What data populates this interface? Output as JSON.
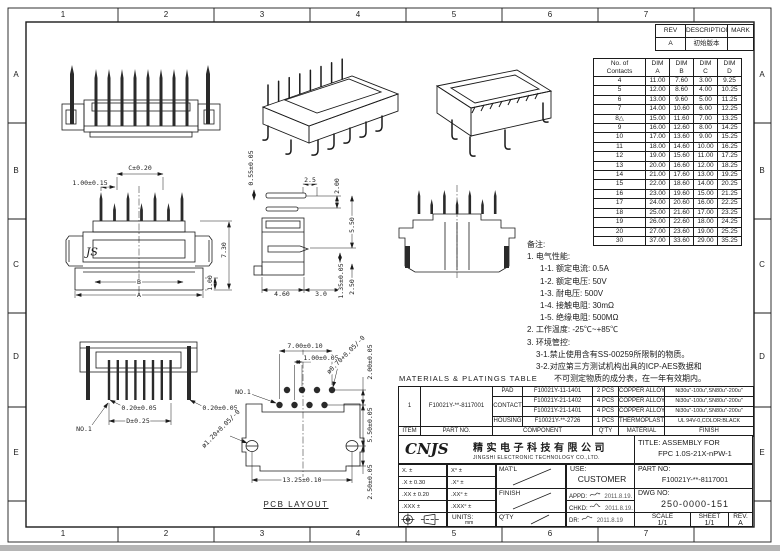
{
  "sheet": {
    "line_color": "#1b1b1b",
    "background": "#ffffff"
  },
  "grid": {
    "cols": [
      "1",
      "2",
      "3",
      "4",
      "5",
      "6",
      "7"
    ],
    "rows": [
      "A",
      "B",
      "C",
      "D",
      "E"
    ]
  },
  "rev_table": {
    "headers": [
      "REV",
      "DESCRIPTION",
      "MARK"
    ],
    "rows": [
      [
        "A",
        "初始版本",
        ""
      ]
    ]
  },
  "dim_table": {
    "col_headers": [
      [
        "No. of",
        "Contacts"
      ],
      [
        "DIM",
        "A"
      ],
      [
        "DIM",
        "B"
      ],
      [
        "DIM",
        "C"
      ],
      [
        "DIM",
        "D"
      ]
    ],
    "rows": [
      [
        "4",
        "11.00",
        "7.60",
        "3.00",
        "9.25"
      ],
      [
        "5",
        "12.00",
        "8.60",
        "4.00",
        "10.25"
      ],
      [
        "6",
        "13.00",
        "9.60",
        "5.00",
        "11.25"
      ],
      [
        "7",
        "14.00",
        "10.60",
        "6.00",
        "12.25"
      ],
      [
        "8△",
        "15.00",
        "11.60",
        "7.00",
        "13.25"
      ],
      [
        "9",
        "16.00",
        "12.60",
        "8.00",
        "14.25"
      ],
      [
        "10",
        "17.00",
        "13.60",
        "9.00",
        "15.25"
      ],
      [
        "11",
        "18.00",
        "14.60",
        "10.00",
        "16.25"
      ],
      [
        "12",
        "19.00",
        "15.60",
        "11.00",
        "17.25"
      ],
      [
        "13",
        "20.00",
        "16.60",
        "12.00",
        "18.25"
      ],
      [
        "14",
        "21.00",
        "17.60",
        "13.00",
        "19.25"
      ],
      [
        "15",
        "22.00",
        "18.60",
        "14.00",
        "20.25"
      ],
      [
        "16",
        "23.00",
        "19.60",
        "15.00",
        "21.25"
      ],
      [
        "17",
        "24.00",
        "20.60",
        "16.00",
        "22.25"
      ],
      [
        "18",
        "25.00",
        "21.60",
        "17.00",
        "23.25"
      ],
      [
        "19",
        "26.00",
        "22.60",
        "18.00",
        "24.25"
      ],
      [
        "20",
        "27.00",
        "23.60",
        "19.00",
        "25.25"
      ],
      [
        "30",
        "37.00",
        "33.60",
        "29.00",
        "35.25"
      ]
    ]
  },
  "notes": {
    "lines": [
      {
        "t": "备注:",
        "i": 0
      },
      {
        "t": "1. 电气性能:",
        "i": 0
      },
      {
        "t": "1-1. 额定电流: 0.5A",
        "i": 13
      },
      {
        "t": "1-2. 额定电压: 50V",
        "i": 13
      },
      {
        "t": "1-3. 耐电压: 500V",
        "i": 13
      },
      {
        "t": "1-4. 接触电阻: 30mΩ",
        "i": 13
      },
      {
        "t": "1-5. 绝缘电阻: 500MΩ",
        "i": 13
      },
      {
        "t": "2. 工作温度: -25℃~+85℃",
        "i": 0
      },
      {
        "t": "3. 环境管控:",
        "i": 0
      },
      {
        "t": "3-1.禁止使用含有SS-00259所限制的物质。",
        "i": 9
      },
      {
        "t": "3-2.对应第三方测试机构出具的ICP-AES数据和",
        "i": 9
      },
      {
        "t": "不可测定物质的成分表，在一年有效期内。",
        "i": 27
      }
    ]
  },
  "materials": {
    "title": "MATERIALS & PLATINGS TABLE",
    "footer_headers": [
      "ITEM",
      "PART NO.",
      "COMPONENT",
      "Q'TY",
      "MATERIAL",
      "FINISH"
    ],
    "item": "1",
    "part_no": "F10021Y-**-8117001",
    "rows": [
      {
        "component": "PAD",
        "part": "F10021Y-11-1401",
        "qty": "2 PCS",
        "material": "COPPER ALLOY",
        "finish": "Ni30u\"-100u\",SN80u\"-200u\""
      },
      {
        "component": "CONTACT",
        "part": "F10021Y-21-1402",
        "qty": "4 PCS",
        "material": "COPPER ALLOY",
        "finish": "Ni30u\"-100u\",SN80u\"-200u\""
      },
      {
        "component": "",
        "part": "F10021Y-21-1401",
        "qty": "4 PCS",
        "material": "COPPER ALLOY",
        "finish": "Ni30u\"-100u\",SN80u\"-200u\""
      },
      {
        "component": "HOUSING",
        "part": "F10021Y-**-2726",
        "qty": "1 PCS",
        "material": "THERMOPLASTIC",
        "finish": "UL 94V-0,COLOR:BLACK"
      }
    ]
  },
  "title_block": {
    "logo": "CNJS",
    "company_cn": "精实电子科技有限公司",
    "company_en": "JINGSHI ELECTRONIC TECHNOLOGY CO.,LTD.",
    "tolerances": [
      [
        "X. ±",
        "X° ±"
      ],
      [
        ".X ± 0.30",
        ".X° ±"
      ],
      [
        ".XX ± 0.20",
        ".XX° ±"
      ],
      [
        ".XXX ±",
        ".XXX° ±"
      ]
    ],
    "units_label": "UNITS:",
    "units_value": "mm",
    "matl_label": "MAT'L",
    "finish_label": "FINISH",
    "qty_label": "Q'TY",
    "use_label": "USE:",
    "use_value": "CUSTOMER",
    "appd_label": "APPD:",
    "appd_date": "2011.8.19.",
    "chkd_label": "CHKD:",
    "chkd_date": "2011.8.19.",
    "dr_label": "DR:",
    "dr_date": "2011.8.19",
    "title_label": "TITLE:",
    "title_line1": "ASSEMBLY FOR",
    "title_line2": "FPC 1.0S-21X-nPW-1",
    "part_no_label": "PART NO:",
    "part_no": "F10021Y-**-8117001",
    "dwg_no_label": "DWG NO:",
    "dwg_no": "250-0000-151",
    "scale_label": "SCALE",
    "scale": "1/1",
    "sheet_label": "SHEET",
    "sheet": "1/1",
    "rev_label": "REV.",
    "rev": "A"
  },
  "annotations": [
    {
      "t": "C±0.20",
      "x": 140,
      "y": 168
    },
    {
      "t": "1.00±0.15",
      "x": 90,
      "y": 183
    },
    {
      "t": "7.30",
      "x": 224,
      "y": 250,
      "r": -90
    },
    {
      "t": "1.00",
      "x": 210,
      "y": 283,
      "r": -90
    },
    {
      "t": "B",
      "x": 139,
      "y": 282
    },
    {
      "t": "A",
      "x": 139,
      "y": 295
    },
    {
      "t": "JS",
      "x": 92,
      "y": 252,
      "c": "js"
    },
    {
      "t": "0.55±0.05",
      "x": 251,
      "y": 168,
      "r": -90
    },
    {
      "t": "2.5",
      "x": 310,
      "y": 180
    },
    {
      "t": "2.00",
      "x": 337,
      "y": 186,
      "r": -90
    },
    {
      "t": "5.50",
      "x": 352,
      "y": 225,
      "r": -90
    },
    {
      "t": "1.35±0.05",
      "x": 341,
      "y": 281,
      "r": -90
    },
    {
      "t": "2.50",
      "x": 352,
      "y": 287,
      "r": -90
    },
    {
      "t": "4.60",
      "x": 282,
      "y": 294
    },
    {
      "t": "3.0",
      "x": 321,
      "y": 294
    },
    {
      "t": "0.20±0.05",
      "x": 139,
      "y": 408
    },
    {
      "t": "0.20±0.05",
      "x": 220,
      "y": 408
    },
    {
      "t": "D±0.25",
      "x": 138,
      "y": 421
    },
    {
      "t": "NO.1",
      "x": 84,
      "y": 429
    },
    {
      "t": "7.00±0.10",
      "x": 305,
      "y": 346
    },
    {
      "t": "1.00±0.05",
      "x": 321,
      "y": 358
    },
    {
      "t": "ø0.70+0.05/-0",
      "x": 346,
      "y": 355,
      "r": -45
    },
    {
      "t": "NO.1",
      "x": 243,
      "y": 392
    },
    {
      "t": "2.00±0.05",
      "x": 370,
      "y": 362,
      "r": -90
    },
    {
      "t": "5.50±0.05",
      "x": 370,
      "y": 425,
      "r": -90
    },
    {
      "t": "2.50±0.05",
      "x": 370,
      "y": 482,
      "r": -90
    },
    {
      "t": "ø1.20+0.05/-0",
      "x": 221,
      "y": 429,
      "r": -45
    },
    {
      "t": "13.25±0.10",
      "x": 302,
      "y": 480
    },
    {
      "t": "PCB LAYOUT",
      "x": 296,
      "y": 505,
      "c": "pcb"
    }
  ]
}
